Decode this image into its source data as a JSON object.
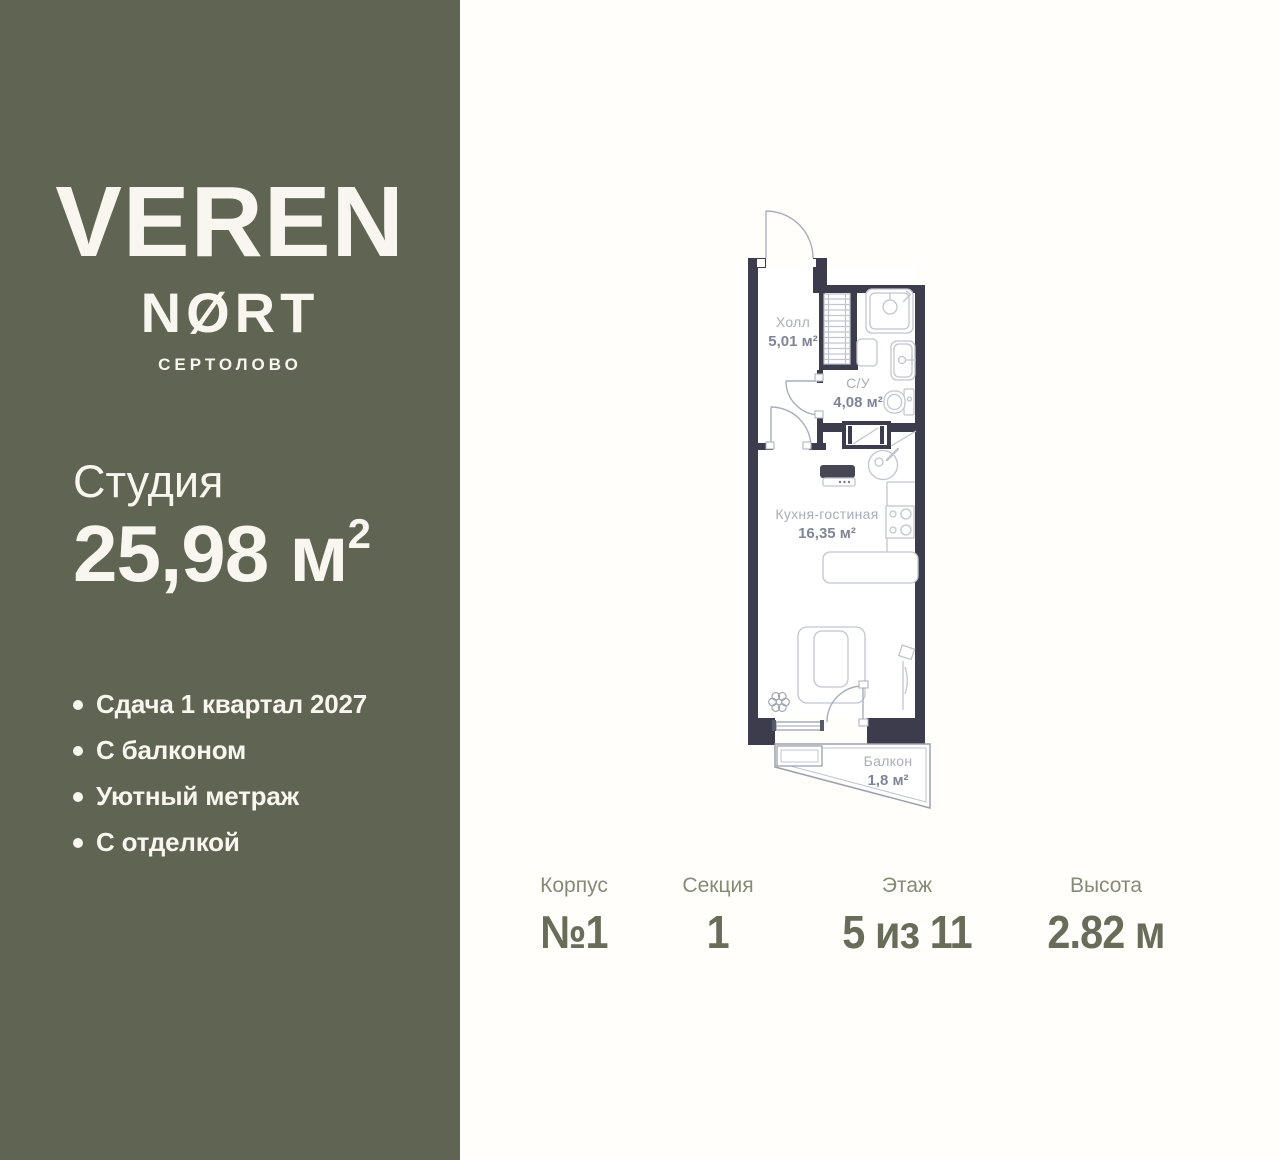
{
  "card": {
    "background": "#fffefb"
  },
  "sidebar": {
    "background": "#5f6453",
    "text_color": "#f8f6ef",
    "logo": {
      "title": "VEREN",
      "subtitle": "NØRT",
      "city": "СЕРТОЛОВО"
    },
    "unit": {
      "type": "Студия",
      "area": "25,98 м",
      "area_sup": "2"
    },
    "features": [
      "Сдача 1 квартал 2027",
      "С балконом",
      "Уютный метраж",
      "С отделкой"
    ]
  },
  "floor_plan": {
    "wall_color": "#3d3c4d",
    "line_color": "#c2c5d0",
    "rooms": {
      "hall": {
        "name": "Холл",
        "area": "5,01 м²"
      },
      "bathroom": {
        "name": "С/У",
        "area": "4,08 м²"
      },
      "kitchen_living": {
        "name": "Кухня-гостиная",
        "area": "16,35 м²"
      },
      "balcony": {
        "name": "Балкон",
        "area": "1,8 м²"
      }
    }
  },
  "stats": [
    {
      "label": "Корпус",
      "value": "№1"
    },
    {
      "label": "Секция",
      "value": "1"
    },
    {
      "label": "Этаж",
      "value": "5 из 11"
    },
    {
      "label": "Высота",
      "value": "2.82 м"
    }
  ]
}
